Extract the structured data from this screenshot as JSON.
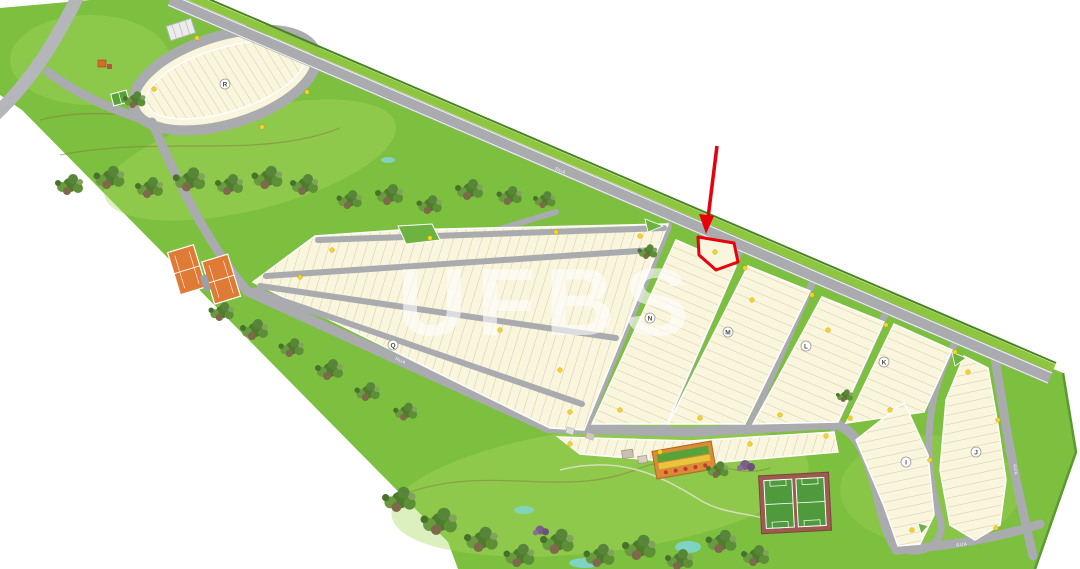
{
  "watermark": {
    "text": "UFBS"
  },
  "blocks": [
    {
      "letter": "R"
    },
    {
      "letter": "Q"
    },
    {
      "letter": "N"
    },
    {
      "letter": "M"
    },
    {
      "letter": "L"
    },
    {
      "letter": "K"
    },
    {
      "letter": "I"
    },
    {
      "letter": "J"
    }
  ],
  "roads": {
    "generic_label": "RUA"
  },
  "highlight": {
    "arrow_color": "#e8000d",
    "lot_outline_color": "#e8000d"
  },
  "markers": {
    "lot_marker_color": "#f5d327"
  },
  "colors": {
    "grass": "#7dbf3e",
    "grass_light": "#a8d95e",
    "lot_fill": "#faf5dd",
    "lot_line": "#cbc199",
    "road": "#a9abae",
    "road_edge": "#ffffff",
    "verge": "#8ec63f",
    "verge_edge": "#46851f",
    "tree_dark": "#4e7c2c",
    "water": "#7fd4c9",
    "tennis_court": "#e07b35",
    "soccer_field": "#4e9a3c",
    "playground": "#d88c36"
  },
  "amenities": [
    {
      "name": "tennis-courts"
    },
    {
      "name": "soccer-fields"
    },
    {
      "name": "playground"
    },
    {
      "name": "pond"
    },
    {
      "name": "tree-areas"
    },
    {
      "name": "parking-area"
    },
    {
      "name": "gatehouse"
    }
  ]
}
